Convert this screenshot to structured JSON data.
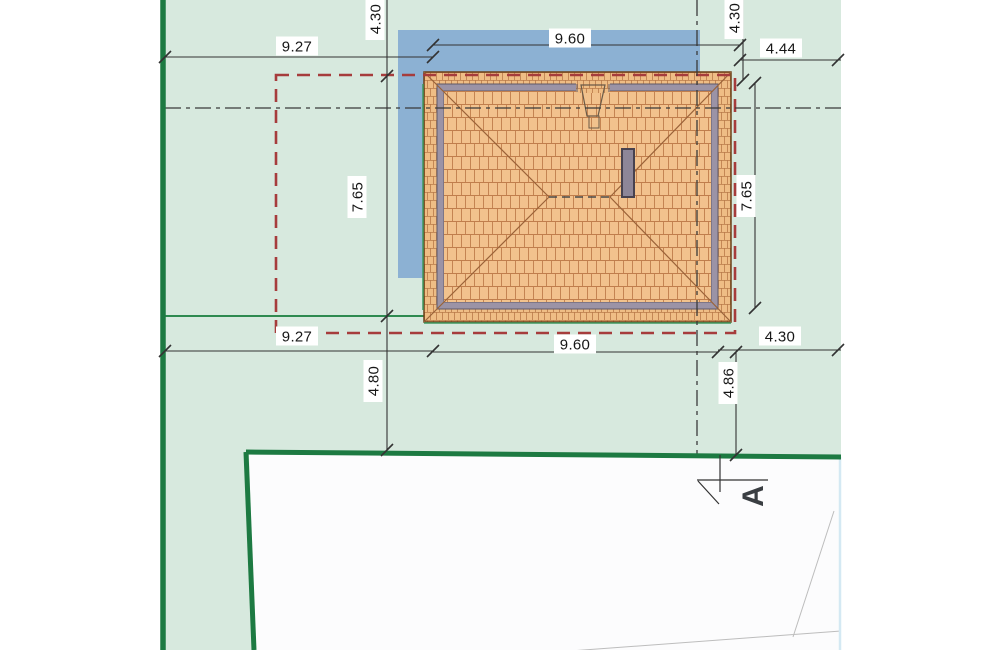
{
  "drawing": {
    "type": "architectural-site-plan",
    "view": "roof-plan"
  },
  "colors": {
    "page_bg": "#ffffff",
    "plot_green": "#d7e9de",
    "boundary_green": "#1d7a42",
    "shadow_blue": "#8cb1d3",
    "roof_tile": "#f2c28d",
    "tile_line": "#c07e4c",
    "roof_outline": "#6b4018",
    "eave_gray": "#9b93a6",
    "eave_edge": "#5f5968",
    "chimney_gray": "#8d8698",
    "chimney_edge": "#47424f",
    "setback_red": "#a63c3c",
    "dim_line": "#333333",
    "label_text": "#161616",
    "road_white": "#fcfcfd",
    "faint_line": "#bdbdbd",
    "scan_edge_blue": "#d4e9f3",
    "thin_green": "#3f9960"
  },
  "dimensions": [
    {
      "id": "top-left-927",
      "label": "9.27",
      "x": 297,
      "y": 46,
      "rotated": false
    },
    {
      "id": "top-960",
      "label": "9.60",
      "x": 570,
      "y": 38,
      "rotated": false
    },
    {
      "id": "top-left-430",
      "label": "4.30",
      "x": 375,
      "y": 19,
      "rotated": true
    },
    {
      "id": "top-right-430",
      "label": "4.30",
      "x": 734,
      "y": 18,
      "rotated": true
    },
    {
      "id": "top-right-444",
      "label": "4.44",
      "x": 781,
      "y": 48,
      "rotated": false
    },
    {
      "id": "left-765",
      "label": "7.65",
      "x": 357,
      "y": 197,
      "rotated": true
    },
    {
      "id": "right-765",
      "label": "7.65",
      "x": 746,
      "y": 196,
      "rotated": true
    },
    {
      "id": "bottom-left-927",
      "label": "9.27",
      "x": 297,
      "y": 336,
      "rotated": false
    },
    {
      "id": "bottom-960",
      "label": "9.60",
      "x": 575,
      "y": 344,
      "rotated": false
    },
    {
      "id": "bottom-right-430",
      "label": "4.30",
      "x": 780,
      "y": 336,
      "rotated": false
    },
    {
      "id": "left-480",
      "label": "4.80",
      "x": 373,
      "y": 381,
      "rotated": true
    },
    {
      "id": "right-486",
      "label": "4.86",
      "x": 728,
      "y": 383,
      "rotated": true
    }
  ],
  "section": {
    "label": "A"
  }
}
